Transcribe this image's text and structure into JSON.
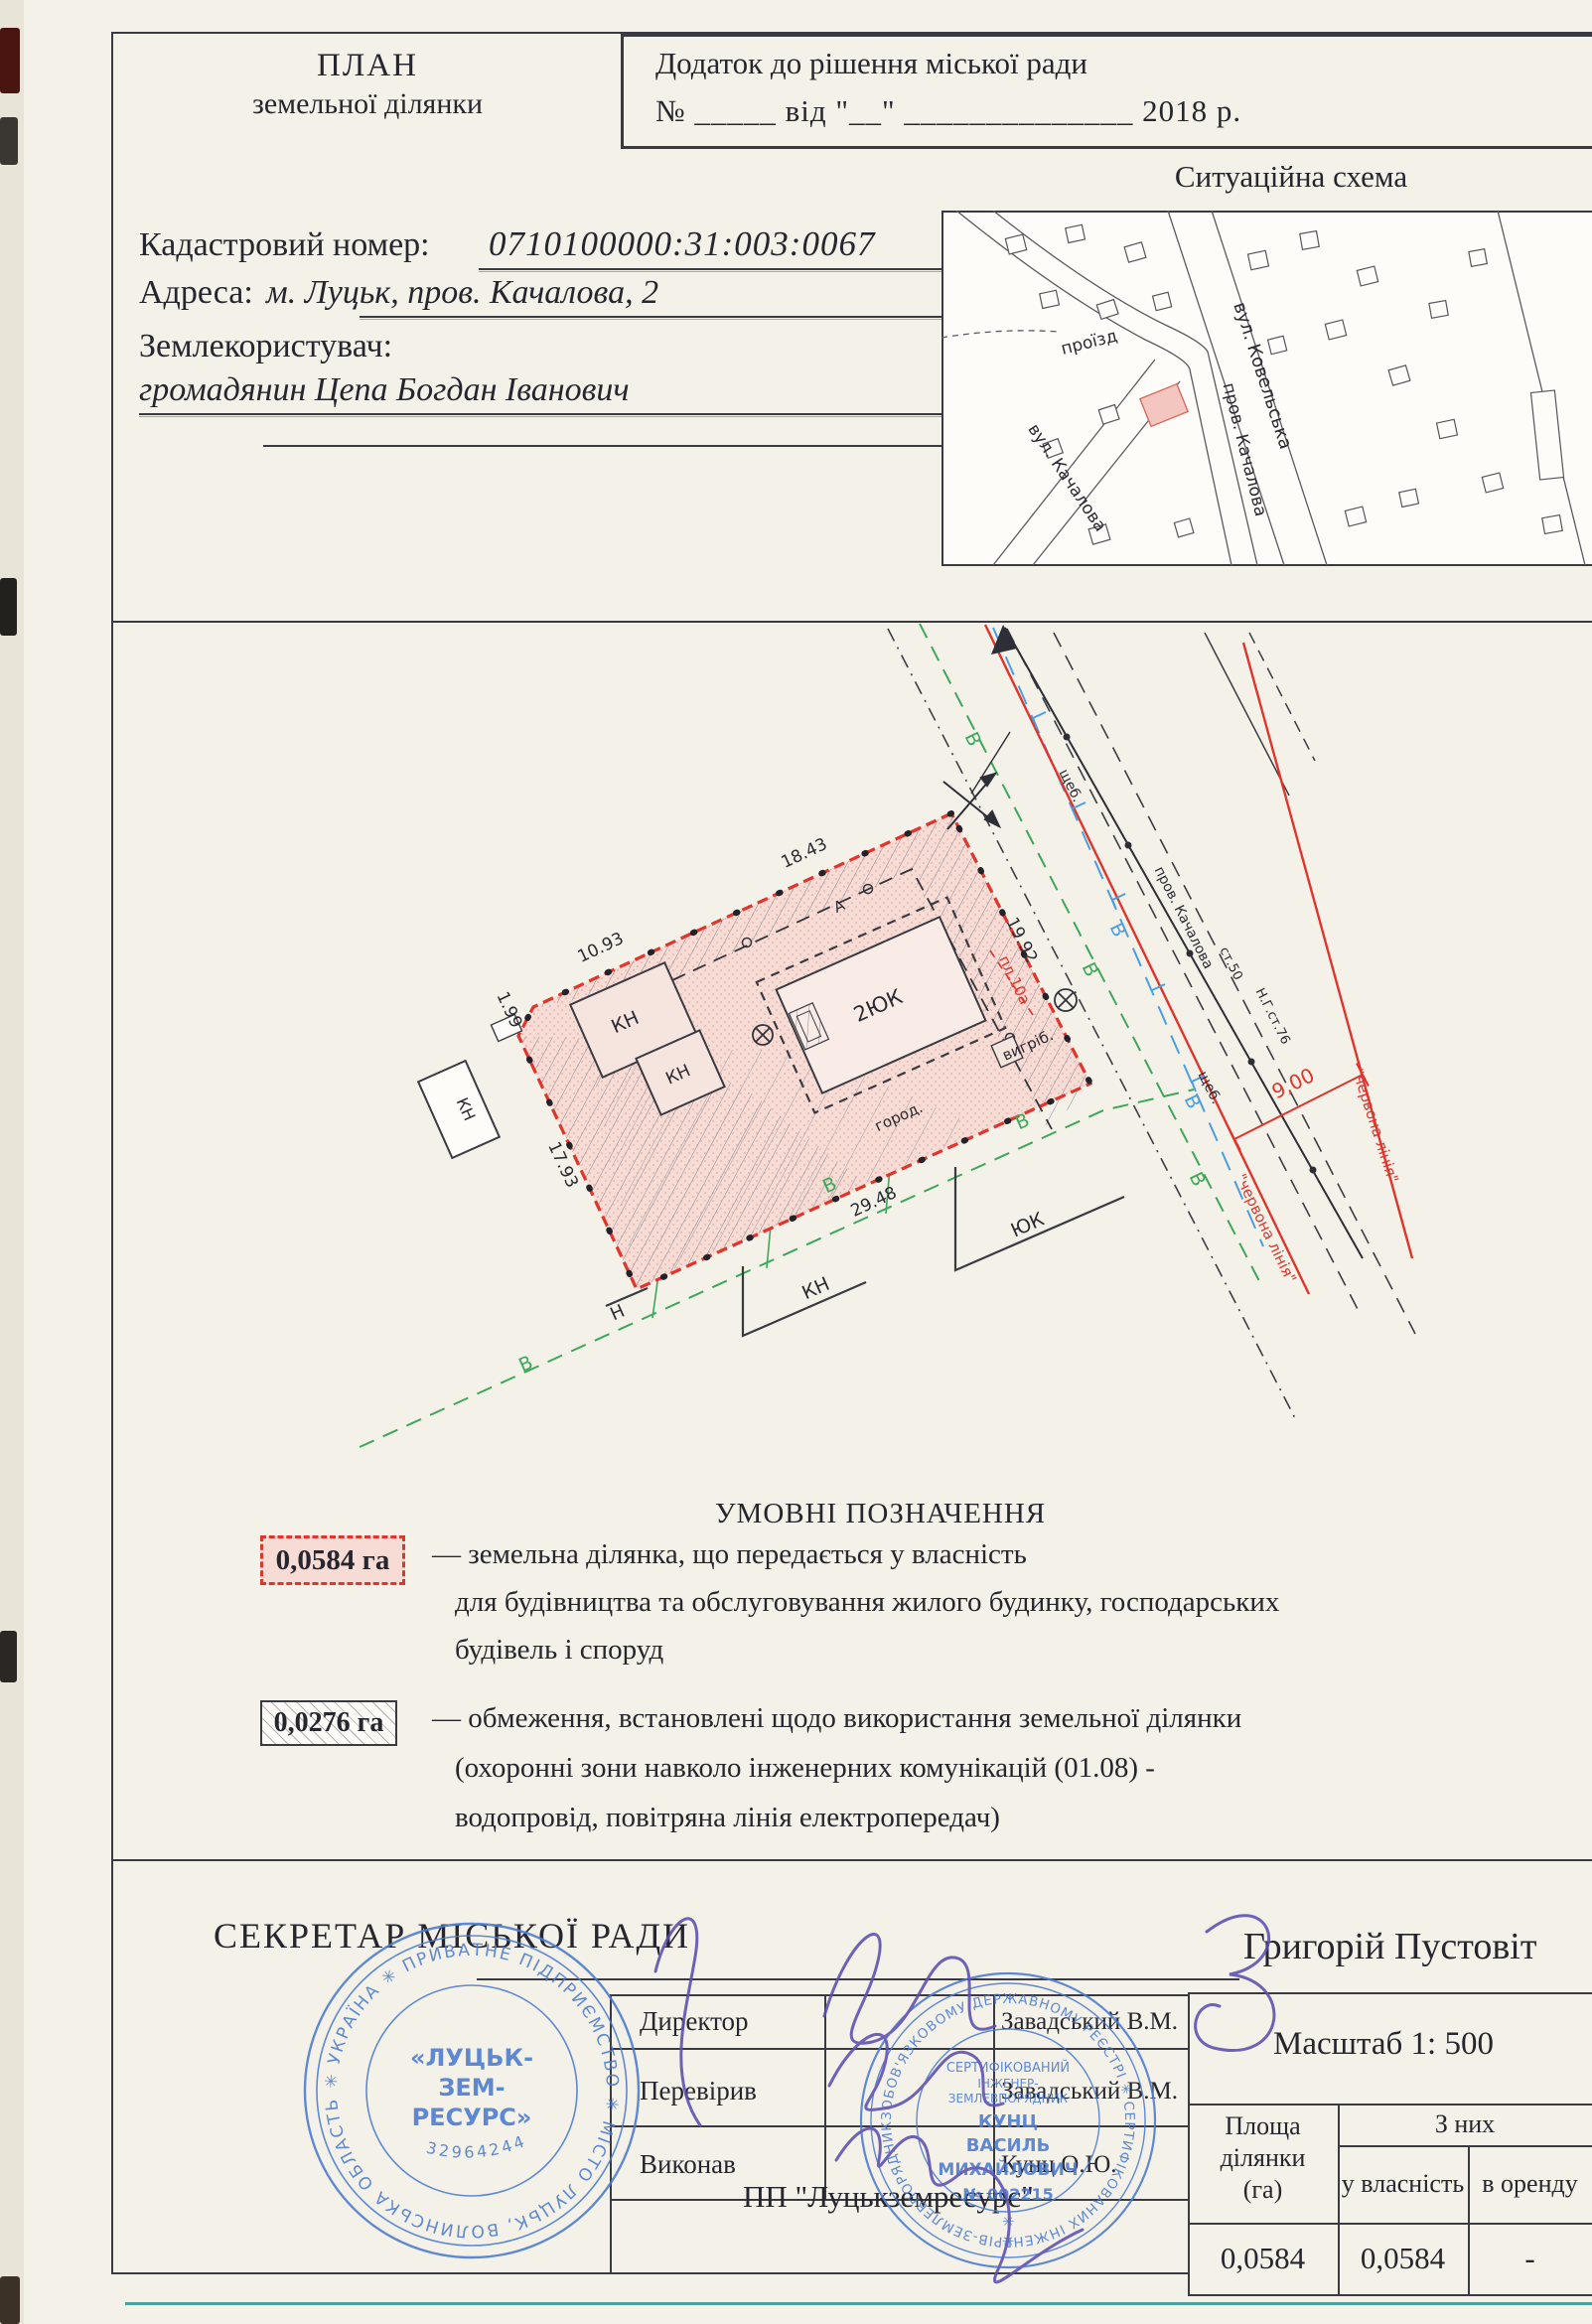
{
  "header": {
    "title_line1": "ПЛАН",
    "title_line2": "земельної ділянки",
    "appendix_line1": "Додаток до рішення  міської ради",
    "appendix_line2": "№ _____  від \"__\" ______________ 2018 р.",
    "cadastral_label": "Кадастровий номер:",
    "cadastral_value": "0710100000:31:003:0067",
    "address_label": "Адреса:",
    "address_value": "м. Луцьк, пров. Качалова, 2",
    "landuser_label": "Землекористувач:",
    "landuser_value": "громадянин Цепа Богдан Іванович"
  },
  "sit": {
    "title": "Ситуаційна схема",
    "streets": {
      "proizd": "проїзд",
      "prov_kachalova": "пров. Качалова",
      "vul_kachalova": "вул. Качалова",
      "vul_kovelska": "вул. Ковельська"
    }
  },
  "plan": {
    "dims": {
      "d1843": "18.43",
      "d1093": "10.93",
      "d199": "1.99",
      "d1793": "17.93",
      "d2948": "29.48",
      "d1992": "19.92",
      "d900": "9,00"
    },
    "bld": {
      "kn": "КН",
      "h2uk": "2ЮК",
      "yuk": "ЮК",
      "n": "Н"
    },
    "labels": {
      "v": "В",
      "a": "А",
      "prov": "пров. Качалова",
      "st50": "ст.50",
      "ng": "Н.Г.ст.76",
      "shcheb": "щеб.",
      "pl10a": "пл.10а",
      "vygrib": "вигріб.",
      "gorod": "город.",
      "red_line": "\"червона лінія\""
    }
  },
  "legend": {
    "title": "УМОВНІ   ПОЗНАЧЕННЯ",
    "item1": {
      "area": "0,0584 га",
      "line1": "— земельна ділянка, що передається у власність",
      "line2": "для будівництва та обслуговування жилого будинку, господарських",
      "line3": "будівель і споруд"
    },
    "item2": {
      "area": "0,0276 га",
      "line1": "— обмеження, встановлені щодо використання земельної ділянки",
      "line2": "(охоронні зони навколо інженерних комунікацій (01.08) -",
      "line3": "водопровід, повітряна лінія електропередач)"
    }
  },
  "footer": {
    "secretary": "СЕКРЕТАР МІСЬКОЇ РАДИ",
    "secretary_name": "Григорій Пустовіт",
    "rows": [
      {
        "label": "Директор",
        "name": "Завадський В.М."
      },
      {
        "label": "Перевірив",
        "name": "Завадський В.М."
      },
      {
        "label": "Виконав",
        "name": "Кунц О.Ю."
      }
    ],
    "company": "ПП \"Луцькземресурс\"",
    "scale": "Масштаб  1: 500",
    "table": {
      "col1_l1": "Площа",
      "col1_l2": "ділянки",
      "col1_l3": "(га)",
      "span": "З них",
      "sub1": "у власність",
      "sub2": "в оренду",
      "v1": "0,0584",
      "v2": "0,0584",
      "v3": "-"
    }
  },
  "stamps": {
    "s1": {
      "ring": "✳ УКРАЇНА ✳ ПРИВАТНЕ ПІДПРИЄМСТВО ✳ МІСТО ЛУЦЬК, ВОЛИНСЬКА ОБЛАСТЬ",
      "name1": "«ЛУЦЬК-",
      "name2": "ЗЕМ-",
      "name3": "РЕСУРС»",
      "code": "32964244"
    },
    "s2": {
      "ring": "ЗОБОВ'ЯЗКОВОМУ ДЕРЖАВНОМУ РЕЄСТРІ ✳ СЕРТИФІКОВАНИХ ІНЖЕНЕРІВ-ЗЕМЛЕВПОРЯДНИКІВ ✳ 2760113537",
      "l1": "СЕРТИФІКОВАНИЙ",
      "l2": "ІНЖЕНЕР-",
      "l3": "ЗЕМЛЕВПОРЯДНИК",
      "l4": "КУНЦ",
      "l5": "ВАСИЛЬ",
      "l6": "МИХАЙЛОВИЧ",
      "l7": "№ 002215"
    }
  },
  "colors": {
    "red": "#e0352c",
    "pink": "#f7dbd5",
    "green": "#3da75a",
    "blue": "#4a9fe0",
    "stamp_blue": "#4a7bd0",
    "pen_purple": "#5b4fae"
  }
}
